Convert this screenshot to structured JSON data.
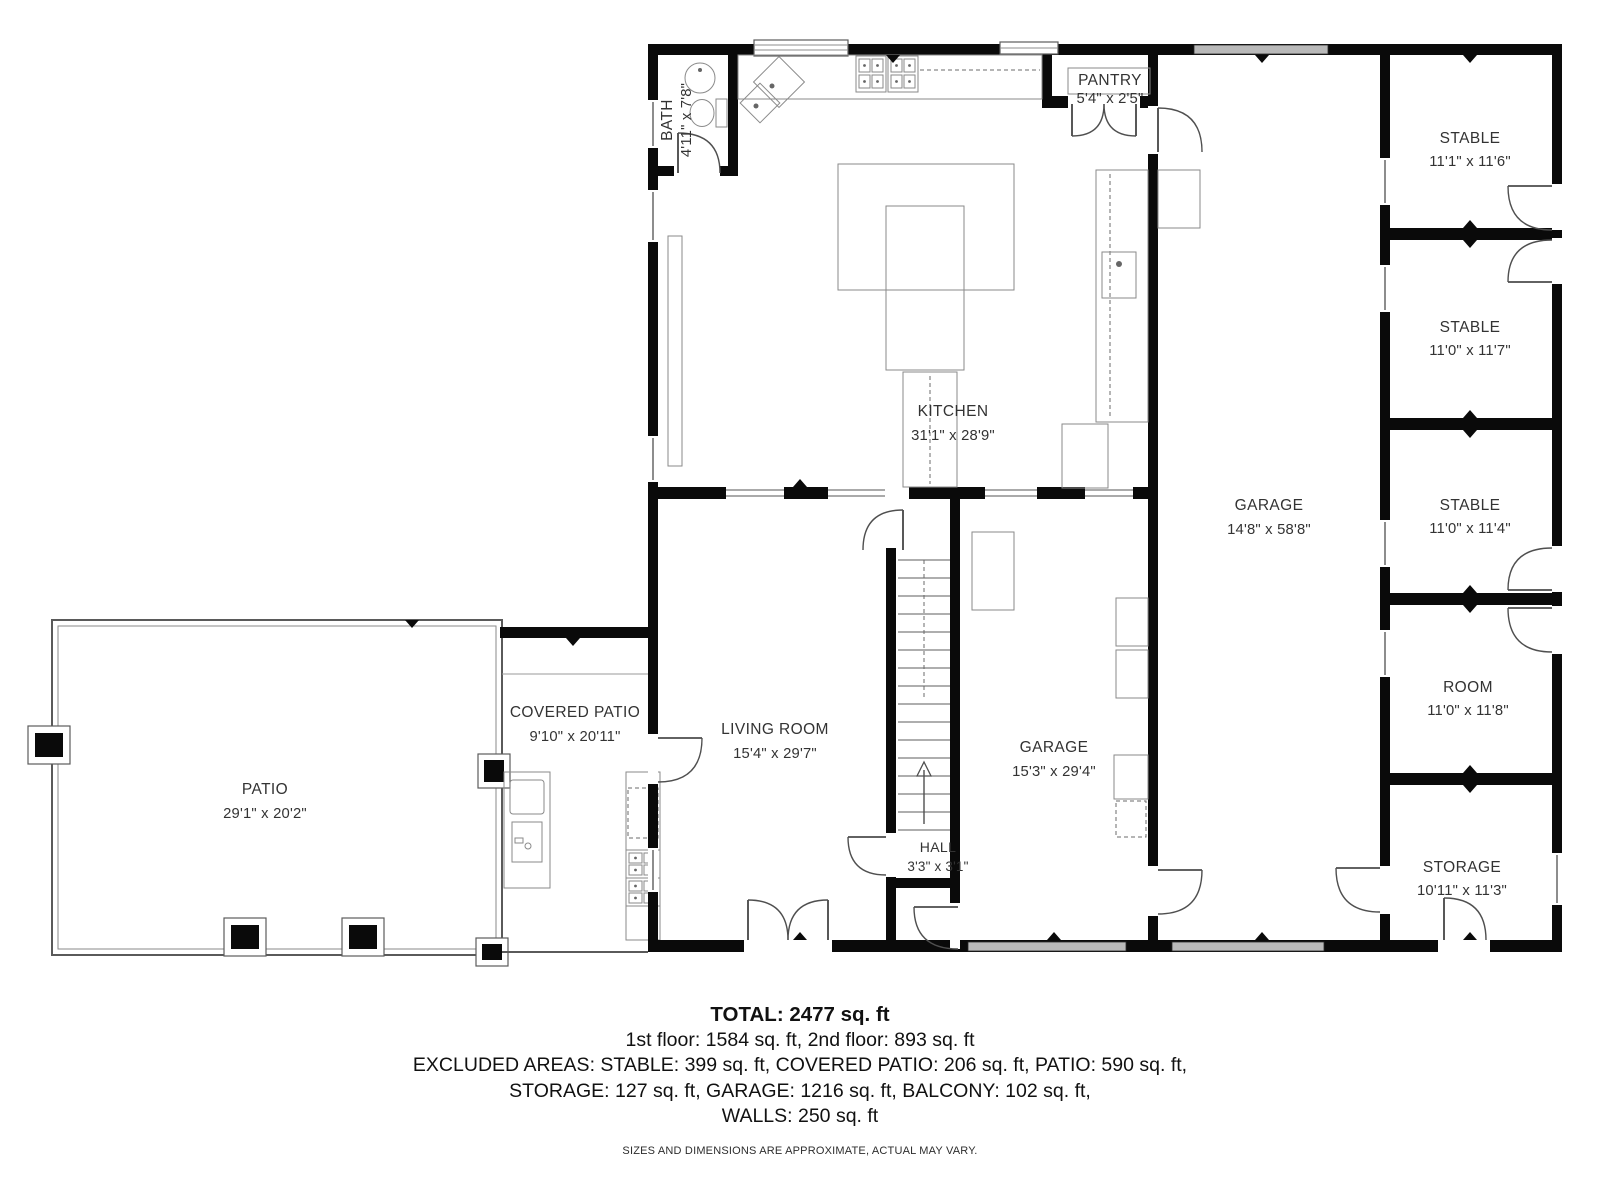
{
  "rooms": {
    "bath": {
      "name": "BATH",
      "dims": "4'11\" x 7'8\""
    },
    "pantry": {
      "name": "PANTRY",
      "dims": "5'4\" x 2'5\""
    },
    "kitchen": {
      "name": "KITCHEN",
      "dims": "31'1\" x 28'9\""
    },
    "garage_main": {
      "name": "GARAGE",
      "dims": "14'8\" x 58'8\""
    },
    "stable_1": {
      "name": "STABLE",
      "dims": "11'1\" x 11'6\""
    },
    "stable_2": {
      "name": "STABLE",
      "dims": "11'0\" x 11'7\""
    },
    "stable_3": {
      "name": "STABLE",
      "dims": "11'0\" x 11'4\""
    },
    "room": {
      "name": "ROOM",
      "dims": "11'0\" x 11'8\""
    },
    "storage": {
      "name": "STORAGE",
      "dims": "10'11\" x 11'3\""
    },
    "living_room": {
      "name": "LIVING ROOM",
      "dims": "15'4\" x 29'7\""
    },
    "hall": {
      "name": "HALL",
      "dims": "3'3\" x 3'1\""
    },
    "garage_2": {
      "name": "GARAGE",
      "dims": "15'3\" x 29'4\""
    },
    "covered_patio": {
      "name": "COVERED PATIO",
      "dims": "9'10\" x 20'11\""
    },
    "patio": {
      "name": "PATIO",
      "dims": "29'1\" x 20'2\""
    }
  },
  "summary": {
    "total": "TOTAL: 2477 sq. ft",
    "floors": "1st floor: 1584 sq. ft, 2nd floor: 893 sq. ft",
    "excluded_1": "EXCLUDED AREAS: STABLE: 399 sq. ft, COVERED PATIO: 206 sq. ft, PATIO: 590 sq. ft,",
    "excluded_2": "STORAGE: 127 sq. ft, GARAGE: 1216 sq. ft, BALCONY: 102 sq. ft,",
    "walls": "WALLS: 250 sq. ft",
    "disclaimer": "SIZES AND DIMENSIONS ARE APPROXIMATE, ACTUAL MAY VARY."
  }
}
